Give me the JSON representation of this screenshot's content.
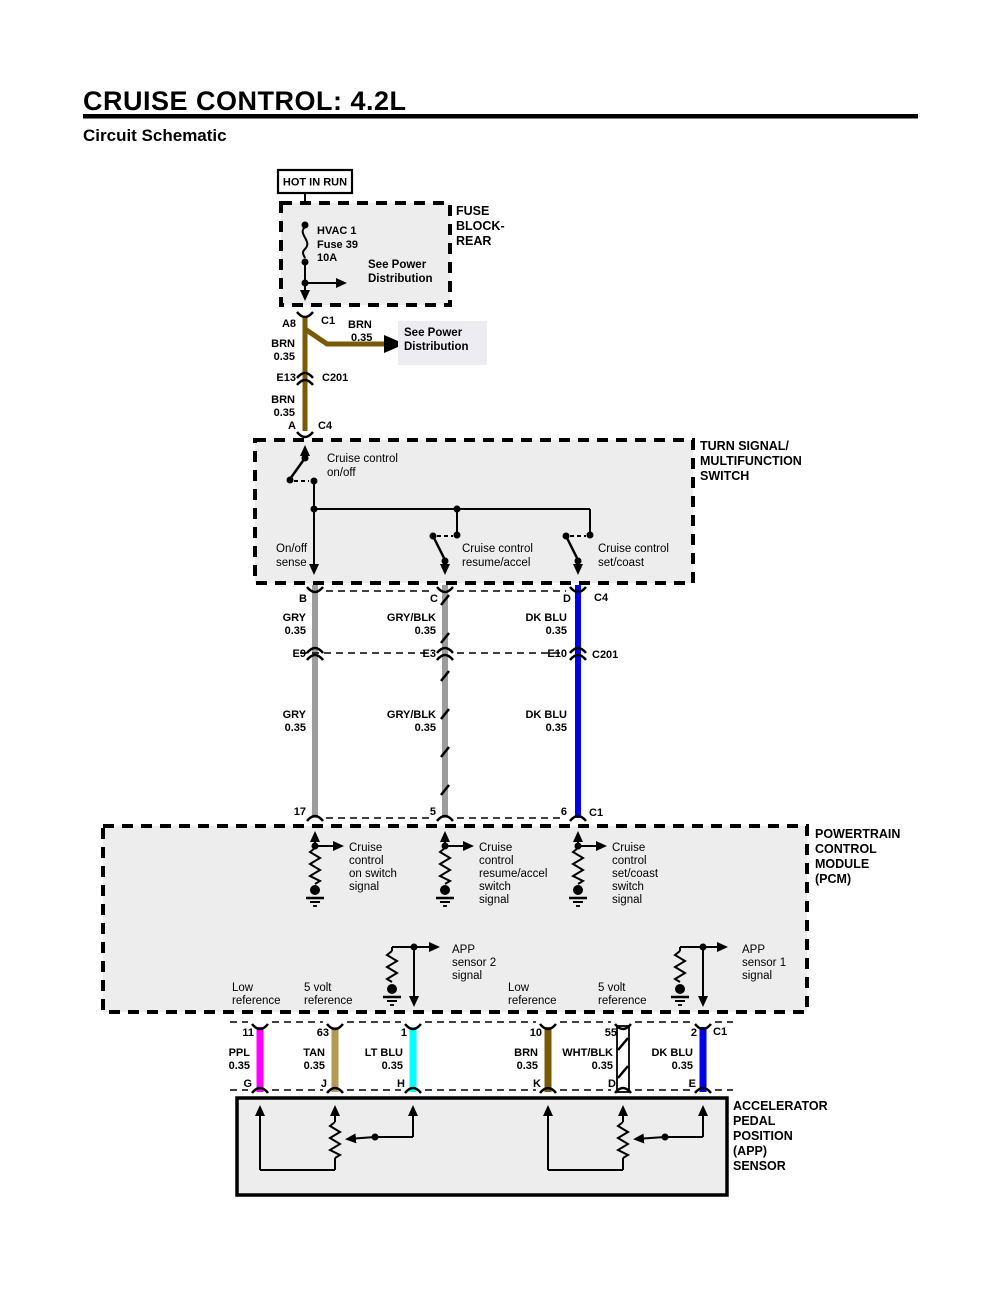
{
  "header": {
    "title": "CRUISE CONTROL: 4.2L",
    "subtitle": "Circuit Schematic"
  },
  "colors": {
    "brn": "#7A5A05",
    "gry": "#9C9C9C",
    "dk_blu": "#0202E8",
    "ppl": "#FF00FF",
    "tan": "#B29A55",
    "lt_blu": "#00FFFF",
    "wht": "#FFFFFF",
    "link_blue": "#2323CC",
    "module_fill": "#EDEDED",
    "note_fill": "#ECECF2"
  },
  "power": {
    "source": "HOT IN RUN",
    "fuse_block_name": [
      "FUSE",
      "BLOCK-",
      "REAR"
    ],
    "fuse": [
      "HVAC 1",
      "Fuse 39",
      "10A"
    ],
    "see_power_1": [
      "See Power",
      "Distribution"
    ],
    "see_power_2": [
      "See Power",
      "Distribution"
    ],
    "pins": {
      "a8": "A8",
      "c1": "C1",
      "e13": "E13",
      "c201": "C201",
      "a": "A",
      "c4": "C4"
    },
    "wire_branch": [
      "BRN",
      "0.35"
    ],
    "wire_upper": [
      "BRN",
      "0.35"
    ],
    "wire_lower": [
      "BRN",
      "0.35"
    ]
  },
  "mfs": {
    "name": [
      "TURN SIGNAL/",
      "MULTIFUNCTION",
      "SWITCH"
    ],
    "onoff_switch": [
      "Cruise control",
      "on/off"
    ],
    "onoff_sense": [
      "On/off",
      "sense"
    ],
    "resume_switch": [
      "Cruise control",
      "resume/accel"
    ],
    "set_switch": [
      "Cruise control",
      "set/coast"
    ],
    "pins": [
      "B",
      "C",
      "D"
    ],
    "connector": "C4"
  },
  "harness_upper": {
    "wires": [
      [
        "GRY",
        "0.35"
      ],
      [
        "GRY/BLK",
        "0.35"
      ],
      [
        "DK BLU",
        "0.35"
      ]
    ],
    "pins": [
      "E9",
      "E3",
      "E10"
    ],
    "connector": "C201"
  },
  "harness_lower": {
    "wires": [
      [
        "GRY",
        "0.35"
      ],
      [
        "GRY/BLK",
        "0.35"
      ],
      [
        "DK BLU",
        "0.35"
      ]
    ],
    "pins": [
      "17",
      "5",
      "6"
    ],
    "connector": "C1"
  },
  "pcm": {
    "name": [
      "POWERTRAIN",
      "CONTROL",
      "MODULE",
      "(PCM)"
    ],
    "on_signal": [
      "Cruise",
      "control",
      "on switch",
      "signal"
    ],
    "resume_signal": [
      "Cruise",
      "control",
      "resume/accel",
      "switch",
      "signal"
    ],
    "set_signal": [
      "Cruise",
      "control",
      "set/coast",
      "switch",
      "signal"
    ],
    "app2_signal": [
      "APP",
      "sensor 2",
      "signal"
    ],
    "app1_signal": [
      "APP",
      "sensor 1",
      "signal"
    ],
    "low_ref_1": [
      "Low",
      "reference"
    ],
    "v5_ref_1": [
      "5 volt",
      "reference"
    ],
    "low_ref_2": [
      "Low",
      "reference"
    ],
    "v5_ref_2": [
      "5 volt",
      "reference"
    ]
  },
  "app_harness": {
    "pins_top": [
      "11",
      "63",
      "1",
      "10",
      "55",
      "2"
    ],
    "connector_top": "C1",
    "wires": [
      [
        "PPL",
        "0.35"
      ],
      [
        "TAN",
        "0.35"
      ],
      [
        "LT BLU",
        "0.35"
      ],
      [
        "BRN",
        "0.35"
      ],
      [
        "WHT/BLK",
        "0.35"
      ],
      [
        "DK BLU",
        "0.35"
      ]
    ],
    "pins_bottom": [
      "G",
      "J",
      "H",
      "K",
      "D",
      "E"
    ]
  },
  "app_sensor": {
    "name": [
      "ACCELERATOR",
      "PEDAL",
      "POSITION",
      "(APP)",
      "SENSOR"
    ]
  }
}
